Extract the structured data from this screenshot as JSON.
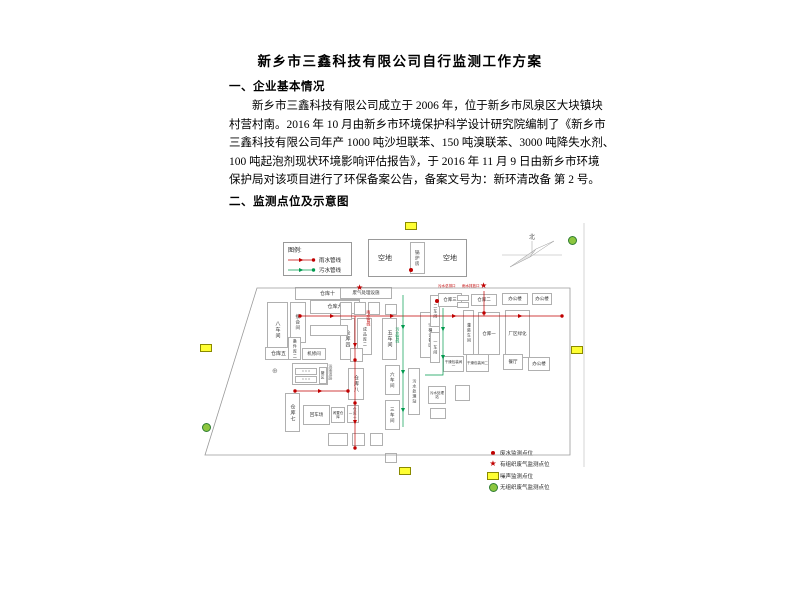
{
  "document": {
    "title": "新乡市三鑫科技有限公司自行监测工作方案",
    "section1_heading": "一、企业基本情况",
    "paragraph_lines": [
      "新乡市三鑫科技有限公司成立于 2006 年，位于新乡市凤泉区大块镇块",
      "村营村南。2016 年 10 月由新乡市环境保护科学设计研究院编制了《新乡市",
      "三鑫科技有限公司年产 1000 吨沙坦联苯、150 吨溴联苯、3000 吨降失水剂、",
      "100 吨起泡剂现状环境影响评估报告》，于 2016 年 11 月 9 日由新乡市环境",
      "保护局对该项目进行了环保备案公告，备案文号为：新环清改备 第 2 号。"
    ],
    "section2_heading": "二、监测点位及示意图"
  },
  "colors": {
    "red": "#c00000",
    "green": "#009a4e",
    "yellow": "#ffff33",
    "yellow_border": "#8a8a00",
    "gas_green": "#8dc63f",
    "gas_border": "#2f7d32",
    "border_gray": "#b0b0b0",
    "text_gray": "#333333"
  },
  "diagram": {
    "north_label": "北",
    "map_legend": {
      "title": "图例:",
      "items": [
        {
          "label": "雨水管线",
          "color": "#c00000"
        },
        {
          "label": "污水管线",
          "color": "#009a4e"
        }
      ]
    },
    "empty_lot_left": "空地",
    "empty_lot_right": "空地",
    "boiler_room": "锅炉房",
    "boundary": "57,73 370,73 370,240 5,240",
    "frame_line": [
      [
        384,
        8
      ],
      [
        384,
        252
      ]
    ],
    "buildings": [
      {
        "l": "仓库十",
        "x": 95,
        "y": 72,
        "w": 65,
        "h": 13
      },
      {
        "l": "仓库九",
        "x": 110,
        "y": 85,
        "w": 50,
        "h": 14
      },
      {
        "l": "八车间",
        "x": 67,
        "y": 87,
        "w": 21,
        "h": 56,
        "v": 1
      },
      {
        "l": "接合间",
        "x": 90,
        "y": 87,
        "w": 16,
        "h": 41,
        "v": 1,
        "fs": 4.5
      },
      {
        "l": "仓库五",
        "x": 65,
        "y": 132,
        "w": 27,
        "h": 13
      },
      {
        "l": "备件库二",
        "x": 88,
        "y": 122,
        "w": 13,
        "h": 23,
        "v": 1,
        "fs": 4
      },
      {
        "l": "机修间",
        "x": 102,
        "y": 133,
        "w": 24,
        "h": 12,
        "fs": 4.5
      },
      {
        "l": "",
        "x": 92,
        "y": 148,
        "w": 36,
        "h": 22
      },
      {
        "l": "○ ○ ○",
        "x": 95,
        "y": 153,
        "w": 22,
        "h": 7,
        "fs": 3.5
      },
      {
        "l": "○ ○ ○",
        "x": 95,
        "y": 161,
        "w": 22,
        "h": 7,
        "fs": 3.5
      },
      {
        "l": "罐区",
        "x": 119,
        "y": 152,
        "w": 8,
        "h": 17,
        "v": 1,
        "fs": 3.5
      },
      {
        "l": "仓库七",
        "x": 85,
        "y": 178,
        "w": 15,
        "h": 39,
        "v": 1
      },
      {
        "l": "回车场",
        "x": 103,
        "y": 190,
        "w": 27,
        "h": 20,
        "fs": 4.5
      },
      {
        "l": "闲置仓库",
        "x": 131,
        "y": 192,
        "w": 14,
        "h": 16,
        "fs": 3.5
      },
      {
        "l": "仓库十一",
        "x": 147,
        "y": 190,
        "w": 12,
        "h": 18,
        "v": 1,
        "fs": 3.5
      },
      {
        "l": "废气处理设施",
        "x": 140,
        "y": 72,
        "w": 52,
        "h": 12,
        "fs": 4.5
      },
      {
        "l": "仓库四",
        "x": 140,
        "y": 103,
        "w": 15,
        "h": 42,
        "v": 1
      },
      {
        "l": "成品库二",
        "x": 157,
        "y": 103,
        "w": 15,
        "h": 37,
        "v": 1,
        "fs": 4
      },
      {
        "l": "五车间",
        "x": 182,
        "y": 103,
        "w": 15,
        "h": 42,
        "v": 1
      },
      {
        "l": "空桶设备区",
        "x": 220,
        "y": 97,
        "w": 20,
        "h": 46,
        "v": 1,
        "fs": 4
      },
      {
        "l": "仓库八",
        "x": 148,
        "y": 153,
        "w": 16,
        "h": 32,
        "v": 1
      },
      {
        "l": "六车间",
        "x": 185,
        "y": 150,
        "w": 15,
        "h": 30,
        "v": 1,
        "fs": 4.5
      },
      {
        "l": "三车间",
        "x": 185,
        "y": 185,
        "w": 15,
        "h": 30,
        "v": 1,
        "fs": 4.5
      },
      {
        "l": "污水处理站",
        "x": 208,
        "y": 153,
        "w": 12,
        "h": 47,
        "v": 1,
        "fs": 4
      },
      {
        "l": "污水处理站",
        "x": 228,
        "y": 171,
        "w": 18,
        "h": 18,
        "fs": 3.5
      },
      {
        "l": "二车间",
        "x": 230,
        "y": 80,
        "w": 10,
        "h": 32,
        "v": 1,
        "fs": 4
      },
      {
        "l": "一车间",
        "x": 230,
        "y": 117,
        "w": 10,
        "h": 31,
        "v": 1,
        "fs": 4
      },
      {
        "l": "仓库三",
        "x": 238,
        "y": 78,
        "w": 24,
        "h": 14,
        "fs": 4.5
      },
      {
        "l": "仓库二",
        "x": 271,
        "y": 79,
        "w": 26,
        "h": 12,
        "fs": 4.5
      },
      {
        "l": "办公楼",
        "x": 302,
        "y": 78,
        "w": 26,
        "h": 12,
        "fs": 4.5
      },
      {
        "l": "办公楼",
        "x": 332,
        "y": 78,
        "w": 20,
        "h": 12,
        "fs": 4.5
      },
      {
        "l": "灌装车间",
        "x": 263,
        "y": 95,
        "w": 11,
        "h": 45,
        "v": 1,
        "fs": 4
      },
      {
        "l": "仓库一",
        "x": 278,
        "y": 97,
        "w": 22,
        "h": 43,
        "fs": 4.5
      },
      {
        "l": "厂区绿化",
        "x": 305,
        "y": 95,
        "w": 25,
        "h": 48,
        "fs": 4.5
      },
      {
        "l": "干燥包装间一",
        "x": 243,
        "y": 141,
        "w": 21,
        "h": 16,
        "fs": 3.5
      },
      {
        "l": "干燥包装间二",
        "x": 266,
        "y": 139,
        "w": 23,
        "h": 18,
        "fs": 3.5
      },
      {
        "l": "餐厅",
        "x": 303,
        "y": 139,
        "w": 20,
        "h": 16,
        "fs": 4.5
      },
      {
        "l": "办公楼",
        "x": 328,
        "y": 142,
        "w": 22,
        "h": 14,
        "fs": 4.5
      }
    ],
    "small_boxes": [
      [
        110,
        110,
        38,
        11
      ],
      [
        150,
        133,
        13,
        14
      ],
      [
        140,
        87,
        12,
        18
      ],
      [
        154,
        87,
        12,
        13
      ],
      [
        168,
        87,
        12,
        13
      ],
      [
        185,
        89,
        12,
        11
      ],
      [
        257,
        80,
        12,
        6
      ],
      [
        257,
        87,
        12,
        6
      ],
      [
        255,
        170,
        15,
        16
      ],
      [
        230,
        193,
        16,
        11
      ],
      [
        128,
        218,
        20,
        13
      ],
      [
        152,
        218,
        13,
        13
      ],
      [
        170,
        218,
        13,
        13
      ],
      [
        185,
        238,
        12,
        10
      ]
    ],
    "annotations": [
      {
        "t": "污水总排口",
        "x": 238,
        "y": 70,
        "c": "#c00000",
        "fs": 3.5
      },
      {
        "t": "雨水排放口",
        "x": 262,
        "y": 70,
        "c": "#c00000",
        "fs": 3.5
      },
      {
        "t": "雨水管线",
        "x": 166,
        "y": 95,
        "c": "#c00000",
        "fs": 4,
        "v": 1
      },
      {
        "t": "污水管线",
        "x": 195,
        "y": 112,
        "c": "#009a4e",
        "fs": 4,
        "v": 1
      },
      {
        "t": "运输道路",
        "x": 128,
        "y": 149,
        "c": "#777777",
        "fs": 4,
        "v": 1
      },
      {
        "t": "⊕",
        "x": 72,
        "y": 153,
        "c": "#888888",
        "fs": 7
      }
    ],
    "pipelines": [
      {
        "c": "#c00000",
        "pts": [
          [
            100,
            101
          ],
          [
            362,
            101
          ]
        ],
        "arr": [
          [
            130,
            101,
            "r"
          ],
          [
            190,
            101,
            "r"
          ],
          [
            252,
            101,
            "r"
          ],
          [
            318,
            101,
            "r"
          ]
        ],
        "dots": [
          [
            100,
            101
          ],
          [
            362,
            101
          ]
        ]
      },
      {
        "c": "#c00000",
        "pts": [
          [
            155,
            101
          ],
          [
            155,
            233
          ]
        ],
        "arr": [
          [
            155,
            128,
            "d"
          ],
          [
            155,
            205,
            "d"
          ]
        ],
        "dots": [
          [
            155,
            145
          ],
          [
            155,
            188
          ],
          [
            155,
            233
          ]
        ]
      },
      {
        "c": "#c00000",
        "pts": [
          [
            95,
            176
          ],
          [
            148,
            176
          ]
        ],
        "arr": [
          [
            118,
            176,
            "r"
          ]
        ],
        "dots": [
          [
            95,
            176
          ],
          [
            148,
            176
          ]
        ]
      },
      {
        "c": "#c00000",
        "pts": [
          [
            284,
            76
          ],
          [
            284,
            101
          ]
        ],
        "arr": [],
        "dots": [
          [
            284,
            98
          ]
        ]
      },
      {
        "c": "#009a4e",
        "pts": [
          [
            203,
            80
          ],
          [
            203,
            212
          ]
        ],
        "arr": [
          [
            203,
            110,
            "d"
          ],
          [
            203,
            155,
            "d"
          ],
          [
            203,
            193,
            "d"
          ]
        ],
        "dots": []
      },
      {
        "c": "#009a4e",
        "pts": [
          [
            243,
            93
          ],
          [
            243,
            160
          ],
          [
            225,
            160
          ]
        ],
        "arr": [
          [
            243,
            112,
            "d"
          ],
          [
            243,
            140,
            "d"
          ]
        ],
        "dots": []
      }
    ],
    "markers": [
      {
        "t": "noise",
        "x": 210,
        "y": 10
      },
      {
        "t": "noise",
        "x": 5,
        "y": 132
      },
      {
        "t": "noise",
        "x": 376,
        "y": 134
      },
      {
        "t": "noise",
        "x": 204,
        "y": 255
      },
      {
        "t": "gas",
        "x": 372,
        "y": 25
      },
      {
        "t": "gas",
        "x": 6,
        "y": 212
      },
      {
        "t": "water",
        "x": 211,
        "y": 55
      },
      {
        "t": "water",
        "x": 237,
        "y": 86
      },
      {
        "t": "stack",
        "x": 160,
        "y": 73
      },
      {
        "t": "stack",
        "x": 284,
        "y": 71
      }
    ],
    "point_legend": {
      "items": [
        {
          "type": "water",
          "label": "废水监测点位"
        },
        {
          "type": "stack",
          "label": "有组织废气监测点位"
        },
        {
          "type": "noise",
          "label": "噪声监测点位"
        },
        {
          "type": "gas",
          "label": "无组织废气监测点位"
        }
      ]
    }
  }
}
